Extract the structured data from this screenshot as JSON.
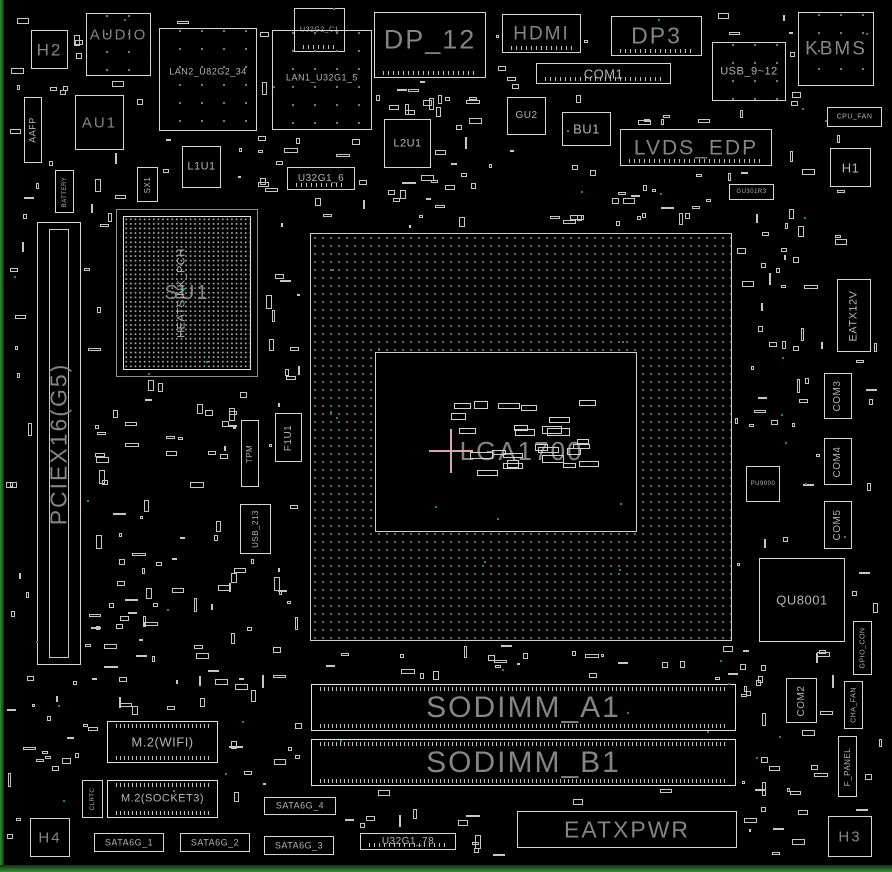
{
  "diagram": {
    "title": "motherboard-layout-diagram",
    "background_color": "#000000",
    "outline_color": "#d6d6d6",
    "label_color_small": "#b4b4b4",
    "label_color_large": "#858585",
    "test_point_color": "#0f8f8f",
    "crosshair_color": "#d9a7a7",
    "board_edge_color": "#35913f",
    "cpu_socket_label": "LGA1700"
  },
  "components": [
    {
      "id": "h2-mount",
      "label": "H2",
      "x": 31,
      "y": 30,
      "w": 37,
      "h": 39,
      "fs": 17
    },
    {
      "id": "audio-connector",
      "label": "AUDIO",
      "x": 86,
      "y": 13,
      "w": 65,
      "h": 63,
      "fs": 15,
      "ly": 34,
      "kind": "dotted"
    },
    {
      "id": "lan2-port",
      "label": "LAN2_U82G2_34",
      "x": 159,
      "y": 28,
      "w": 98,
      "h": 103,
      "fs": 9,
      "ly": 43,
      "kind": "dotted"
    },
    {
      "id": "u32g2-c1-connector",
      "label": "U32G2_C1",
      "x": 294,
      "y": 8,
      "w": 51,
      "h": 44,
      "fs": 7,
      "kind": "pinrow"
    },
    {
      "id": "lan1-port",
      "label": "LAN1_U32G1_5",
      "x": 272,
      "y": 30,
      "w": 100,
      "h": 100,
      "fs": 9,
      "ly": 48,
      "kind": "dotted"
    },
    {
      "id": "dp-12-port",
      "label": "DP_12",
      "x": 374,
      "y": 12,
      "w": 112,
      "h": 66,
      "fs": 27,
      "ly": 42,
      "kind": "pinrow"
    },
    {
      "id": "hdmi-port",
      "label": "HDMI",
      "x": 502,
      "y": 14,
      "w": 79,
      "h": 39,
      "fs": 19,
      "kind": "pinrow"
    },
    {
      "id": "com1-header",
      "label": "COM1",
      "x": 536,
      "y": 63,
      "w": 135,
      "h": 21,
      "fs": 13,
      "kind": "pinrow"
    },
    {
      "id": "dp3-port",
      "label": "DP3",
      "x": 611,
      "y": 16,
      "w": 91,
      "h": 40,
      "fs": 23,
      "kind": "pinrow"
    },
    {
      "id": "usb-9-12-header",
      "label": "USB_9~12",
      "x": 712,
      "y": 42,
      "w": 74,
      "h": 59,
      "fs": 11,
      "kind": "dotted"
    },
    {
      "id": "kbms-port",
      "label": "KBMS",
      "x": 798,
      "y": 12,
      "w": 76,
      "h": 74,
      "fs": 19,
      "kind": "dotted"
    },
    {
      "id": "cpu-fan-header",
      "label": "CPU_FAN",
      "x": 827,
      "y": 107,
      "w": 55,
      "h": 20,
      "fs": 7
    },
    {
      "id": "aafp-header",
      "label": "AAFP",
      "x": 24,
      "y": 97,
      "w": 18,
      "h": 66,
      "dir": "v",
      "fs": 9
    },
    {
      "id": "au1-chip",
      "label": "AU1",
      "x": 75,
      "y": 95,
      "w": 49,
      "h": 55,
      "fs": 15
    },
    {
      "id": "battery",
      "label": "BATTERY",
      "x": 55,
      "y": 170,
      "w": 19,
      "h": 43,
      "dir": "v",
      "fs": 6
    },
    {
      "id": "sx1",
      "label": "SX1",
      "x": 137,
      "y": 167,
      "w": 21,
      "h": 35,
      "dir": "v",
      "fs": 8
    },
    {
      "id": "l1u1-chip",
      "label": "L1U1",
      "x": 182,
      "y": 146,
      "w": 39,
      "h": 42,
      "fs": 11
    },
    {
      "id": "u32g1-6-header",
      "label": "U32G1_6",
      "x": 287,
      "y": 167,
      "w": 68,
      "h": 23,
      "fs": 10,
      "kind": "pinrow"
    },
    {
      "id": "l2u1-chip",
      "label": "L2U1",
      "x": 384,
      "y": 119,
      "w": 47,
      "h": 49,
      "fs": 11
    },
    {
      "id": "gu2-chip",
      "label": "GU2",
      "x": 507,
      "y": 97,
      "w": 39,
      "h": 38,
      "fs": 10
    },
    {
      "id": "bu1-chip",
      "label": "BU1",
      "x": 562,
      "y": 112,
      "w": 49,
      "h": 34,
      "fs": 13
    },
    {
      "id": "lvds-edp-header",
      "label": "LVDS_EDP",
      "x": 620,
      "y": 129,
      "w": 152,
      "h": 37,
      "fs": 21,
      "kind": "pinrow"
    },
    {
      "id": "h1-mount",
      "label": "H1",
      "x": 830,
      "y": 148,
      "w": 41,
      "h": 39,
      "fs": 13
    },
    {
      "id": "gu301r3-part",
      "label": "GU301R3",
      "x": 729,
      "y": 184,
      "w": 45,
      "h": 16,
      "fs": 6
    },
    {
      "id": "pciex16-slot",
      "label": "PCIEX16(G5)",
      "x": 37,
      "y": 222,
      "w": 44,
      "h": 443,
      "dir": "v",
      "fs": 23,
      "kind": "slot"
    },
    {
      "id": "pch-frame",
      "label": "",
      "x": 116,
      "y": 209,
      "w": 142,
      "h": 168,
      "kind": "bgaframe"
    },
    {
      "id": "pch-bga",
      "label": "SU1",
      "x": 123,
      "y": 216,
      "w": 128,
      "h": 154,
      "fs": 20,
      "kind": "bga"
    },
    {
      "id": "pch-heatsink-label",
      "label": "HEATSINK_PCH",
      "x": 170,
      "y": 230,
      "w": 24,
      "h": 126,
      "dir": "v",
      "fs": 11,
      "kind": "ghost"
    },
    {
      "id": "cpu-area",
      "label": "",
      "x": 310,
      "y": 233,
      "w": 422,
      "h": 408,
      "kind": "sockout"
    },
    {
      "id": "cpu-socket",
      "label": "LGA1700",
      "x": 375,
      "y": 352,
      "w": 262,
      "h": 180,
      "fs": 26,
      "lx": 56,
      "ly": 55,
      "kind": "sockin"
    },
    {
      "id": "tpm-header",
      "label": "TPM",
      "x": 241,
      "y": 420,
      "w": 18,
      "h": 67,
      "dir": "v",
      "fs": 8
    },
    {
      "id": "f1u1",
      "label": "F1U1",
      "x": 275,
      "y": 413,
      "w": 27,
      "h": 49,
      "dir": "v",
      "fs": 10
    },
    {
      "id": "usb-213-header",
      "label": "USB_213",
      "x": 240,
      "y": 504,
      "w": 31,
      "h": 50,
      "dir": "v",
      "fs": 8
    },
    {
      "id": "eatx12v-connector",
      "label": "EATX12V",
      "x": 837,
      "y": 279,
      "w": 34,
      "h": 73,
      "dir": "v",
      "fs": 11
    },
    {
      "id": "com3-header",
      "label": "COM3",
      "x": 824,
      "y": 373,
      "w": 28,
      "h": 46,
      "dir": "v",
      "fs": 10
    },
    {
      "id": "com4-header",
      "label": "COM4",
      "x": 824,
      "y": 438,
      "w": 28,
      "h": 47,
      "dir": "v",
      "fs": 10
    },
    {
      "id": "com5-header",
      "label": "COM5",
      "x": 824,
      "y": 501,
      "w": 28,
      "h": 48,
      "dir": "v",
      "fs": 10
    },
    {
      "id": "pu9000-chip",
      "label": "PU9000",
      "x": 746,
      "y": 466,
      "w": 34,
      "h": 36,
      "fs": 6
    },
    {
      "id": "qu8001-chip",
      "label": "QU8001",
      "x": 759,
      "y": 558,
      "w": 86,
      "h": 84,
      "fs": 13
    },
    {
      "id": "gpio-con-header",
      "label": "GPIO_CON",
      "x": 853,
      "y": 621,
      "w": 19,
      "h": 54,
      "dir": "v",
      "fs": 7
    },
    {
      "id": "com2-header",
      "label": "COM2",
      "x": 786,
      "y": 678,
      "w": 31,
      "h": 45,
      "dir": "v",
      "fs": 10
    },
    {
      "id": "cha-fan-header",
      "label": "CHA_FAN",
      "x": 844,
      "y": 681,
      "w": 19,
      "h": 48,
      "dir": "v",
      "fs": 7
    },
    {
      "id": "f-panel-header",
      "label": "F_PANEL",
      "x": 838,
      "y": 736,
      "w": 19,
      "h": 61,
      "dir": "v",
      "fs": 8
    },
    {
      "id": "h3-mount",
      "label": "H3",
      "x": 828,
      "y": 816,
      "w": 44,
      "h": 41,
      "fs": 15
    },
    {
      "id": "sodimm-a1-slot",
      "label": "SODIMM_A1",
      "x": 311,
      "y": 684,
      "w": 425,
      "h": 47,
      "fs": 30,
      "kind": "dimm"
    },
    {
      "id": "sodimm-b1-slot",
      "label": "SODIMM_B1",
      "x": 311,
      "y": 739,
      "w": 425,
      "h": 47,
      "fs": 30,
      "kind": "dimm"
    },
    {
      "id": "m2-wifi-slot",
      "label": "M.2(WIFI)",
      "x": 107,
      "y": 721,
      "w": 111,
      "h": 42,
      "fs": 13,
      "kind": "dimm"
    },
    {
      "id": "m2-socket3-slot",
      "label": "M.2(SOCKET3)",
      "x": 107,
      "y": 780,
      "w": 111,
      "h": 38,
      "fs": 11,
      "kind": "dimm"
    },
    {
      "id": "clrtc-jumper",
      "label": "CLRTC",
      "x": 82,
      "y": 780,
      "w": 21,
      "h": 38,
      "dir": "v",
      "fs": 6
    },
    {
      "id": "h4-mount",
      "label": "H4",
      "x": 30,
      "y": 818,
      "w": 40,
      "h": 39,
      "fs": 15
    },
    {
      "id": "sata6g-1-connector",
      "label": "SATA6G_1",
      "x": 94,
      "y": 833,
      "w": 70,
      "h": 19,
      "fs": 9
    },
    {
      "id": "sata6g-2-connector",
      "label": "SATA6G_2",
      "x": 180,
      "y": 833,
      "w": 70,
      "h": 19,
      "fs": 9
    },
    {
      "id": "sata6g-3-connector",
      "label": "SATA6G_3",
      "x": 264,
      "y": 836,
      "w": 70,
      "h": 19,
      "fs": 9
    },
    {
      "id": "sata6g-4-connector",
      "label": "SATA6G_4",
      "x": 264,
      "y": 797,
      "w": 72,
      "h": 18,
      "fs": 9
    },
    {
      "id": "u32g1-78-header",
      "label": "U32G1_78",
      "x": 360,
      "y": 833,
      "w": 96,
      "h": 17,
      "fs": 10,
      "kind": "pinrow"
    },
    {
      "id": "eatxpwr-connector",
      "label": "EATXPWR",
      "x": 517,
      "y": 811,
      "w": 220,
      "h": 37,
      "fs": 23
    }
  ]
}
